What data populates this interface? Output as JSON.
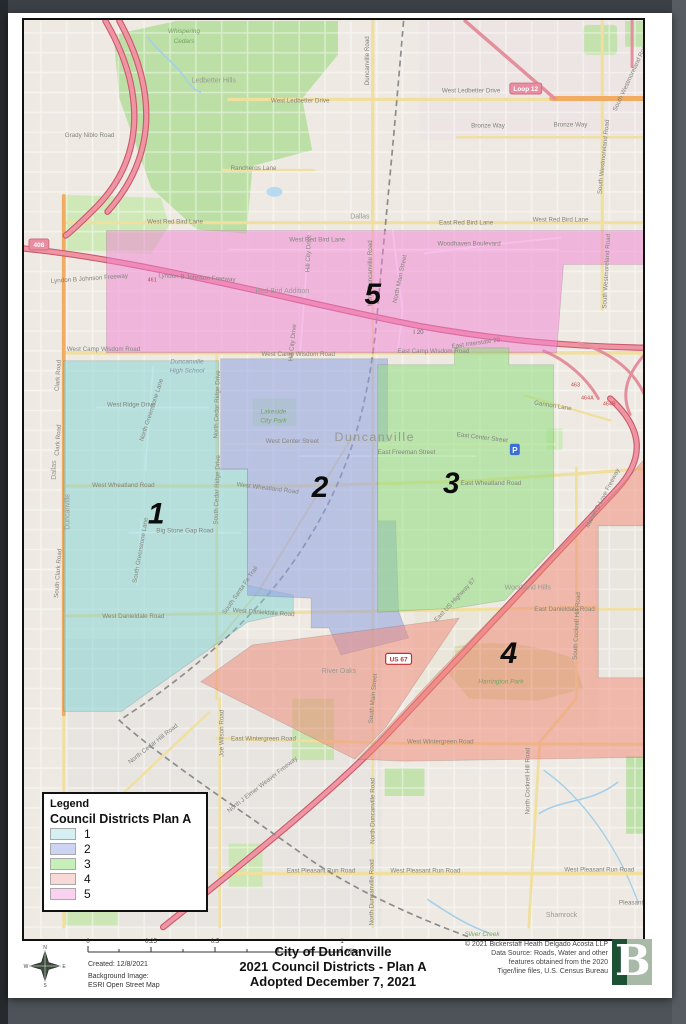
{
  "legend": {
    "title": "Legend",
    "subtitle": "Council Districts Plan A",
    "items": [
      {
        "label": "1",
        "color": "#d4f0f2",
        "dots": "false"
      },
      {
        "label": "2",
        "color": "#cdd3f2",
        "dots": "true"
      },
      {
        "label": "3",
        "color": "#c6efba",
        "dots": "false"
      },
      {
        "label": "4",
        "color": "#f7d9d5",
        "dots": "true"
      },
      {
        "label": "5",
        "color": "#fad2f0",
        "dots": "false"
      }
    ]
  },
  "footer": {
    "title1": "City of Duncanville",
    "title2": "2021 Council Districts - Plan A",
    "title3": "Adopted December 7, 2021",
    "created": "Created: 12/8/2021",
    "bg_label": "Background Image:",
    "bg_value": "ESRI Open Street Map",
    "logo_letter": "B",
    "compass": {
      "n": "N",
      "e": "E",
      "s": "S",
      "w": "W"
    },
    "scale": {
      "unit": "Miles",
      "ticks": [
        {
          "t": "0",
          "x": 80
        },
        {
          "t": "0.25",
          "x": 143
        },
        {
          "t": "0.5",
          "x": 207
        },
        {
          "t": "1",
          "x": 334
        }
      ]
    },
    "copyright": [
      {
        "t": "© 2021 Bickerstaff Heath Delgado Acosta LLP",
        "y": 933
      },
      {
        "t": "Data Source: Roads, Water and other",
        "y": 942
      },
      {
        "t": "features obtained from the 2020",
        "y": 951
      },
      {
        "t": "Tiger/line files, U.S. Census Bureau",
        "y": 960
      }
    ]
  },
  "map": {
    "poi_p": "P",
    "districts": [
      {
        "num": "5",
        "color": "#f07fd4",
        "op": "0.5",
        "d": "M105,229 L650,229 L650,263 L565,263 L558,352 L105,352 Z",
        "tf": "translate(373,303)"
      },
      {
        "num": "1",
        "color": "#7ed2d2",
        "op": "0.5",
        "d": "M62,360 L218,360 L218,469 L247,469 L247,586 L293,596 L293,613 L247,623 L120,713 L62,713 Z",
        "tf": "translate(155,524)"
      },
      {
        "num": "2",
        "color": "#8fa0e2",
        "op": "0.55",
        "d": "M220,358 L388,358 L388,441 L378,441 L378,521 L396,521 L399,612 L409,639 L341,656 L329,629 L311,629 L311,599 L247,596 L247,469 L220,469 Z",
        "tf": "translate(320,497)"
      },
      {
        "num": "3",
        "color": "#8fdc7d",
        "op": "0.55",
        "d": "M378,364 L455,364 L455,347 L510,347 L510,364 L555,364 L555,549 L506,601 L456,609 L378,613 Z",
        "tf": "translate(452,493)"
      },
      {
        "num": "4",
        "color": "#f08573",
        "op": "0.5",
        "d": "M655,449 L655,526 L600,526 L600,679 L655,679 L655,759 L405,763 L358,761 L440,673 L530,581 L621,488 Z M200,683 L355,761 L386,729 L460,619 L252,646 Z",
        "tf": "translate(510,664)"
      }
    ],
    "shields": [
      {
        "t": "Loop 12",
        "tf": "translate(527,86)",
        "cls": "sh-loop",
        "tcls": "sh-txt-loop",
        "w": 32,
        "xo": -16
      },
      {
        "t": "408",
        "tf": "translate(37,243)",
        "cls": "sh-loop",
        "tcls": "sh-txt-loop",
        "w": 20,
        "xo": -10
      },
      {
        "t": "US 67",
        "tf": "translate(399,660)",
        "cls": "sh-us",
        "tcls": "sh-txt-us",
        "w": 26,
        "xo": -13
      }
    ],
    "exits": [
      {
        "t": "461",
        "tf": "translate(151,280)"
      },
      {
        "t": "463",
        "tf": "translate(577,386)"
      },
      {
        "t": "464A",
        "tf": "translate(589,399)"
      },
      {
        "t": "464B",
        "tf": "translate(611,405)"
      },
      {
        "t": "I 20",
        "tf": "translate(419,333)",
        "c": "i20"
      }
    ],
    "labels": [
      {
        "t": "Whispering",
        "tf": "translate(183,30)",
        "c": "place"
      },
      {
        "t": "Cedars",
        "tf": "translate(183,40)",
        "c": "place"
      },
      {
        "t": "Ledbetter Hills",
        "tf": "translate(213,80)",
        "c": "hood"
      },
      {
        "t": "West Ledbetter Drive",
        "tf": "translate(300,100)"
      },
      {
        "t": "West Ledbetter Drive",
        "tf": "translate(472,90)"
      },
      {
        "t": "Bronze Way",
        "tf": "translate(489,125)"
      },
      {
        "t": "Bronze Way",
        "tf": "translate(572,124)"
      },
      {
        "t": "Grady Niblo Road",
        "tf": "translate(88,135)"
      },
      {
        "t": "Rancheros Lane",
        "tf": "translate(253,168)"
      },
      {
        "t": "West Red Bird Lane",
        "tf": "translate(174,222)"
      },
      {
        "t": "East Red Bird Lane",
        "tf": "translate(467,223)"
      },
      {
        "t": "West Red Bird Lane",
        "tf": "translate(562,220)"
      },
      {
        "t": "West Red Bird Lane",
        "tf": "translate(317,240)"
      },
      {
        "t": "Woodhaven Boulevard",
        "tf": "translate(470,244)"
      },
      {
        "t": "Dallas",
        "tf": "translate(360,217)",
        "c": "hood"
      },
      {
        "t": "Lyndon B Johnson Freeway",
        "tf": "translate(88,279) rotate(-4)"
      },
      {
        "t": "Lyndon B Johnson Freeway",
        "tf": "translate(196,278) rotate(3)"
      },
      {
        "t": "Red Bird Addition",
        "tf": "translate(282,292)",
        "c": "hood"
      },
      {
        "t": "North Duncanville Road",
        "tf": "translate(372,272) rotate(-90)"
      },
      {
        "t": "North Main Street",
        "tf": "translate(402,278) rotate(-78)"
      },
      {
        "t": "Hill City Drive",
        "tf": "translate(310,252) rotate(-88)"
      },
      {
        "t": "Hill City Drive",
        "tf": "translate(294,342) rotate(-84)"
      },
      {
        "t": "East Interstate 20",
        "tf": "translate(477,344) rotate(-8)"
      },
      {
        "t": "West Camp Wisdom Road",
        "tf": "translate(102,350)"
      },
      {
        "t": "West Camp Wisdom Road",
        "tf": "translate(298,355)"
      },
      {
        "t": "East Camp Wisdom Road",
        "tf": "translate(434,352)"
      },
      {
        "t": "Gannon Lane",
        "tf": "translate(554,407) rotate(9)"
      },
      {
        "t": "Duncanville",
        "tf": "translate(186,363)",
        "c": "school"
      },
      {
        "t": "High School",
        "tf": "translate(186,372)",
        "c": "school"
      },
      {
        "t": "West Ridge Drive",
        "tf": "translate(130,406)"
      },
      {
        "t": "North Greenstone Lane",
        "tf": "translate(152,410) rotate(-72)"
      },
      {
        "t": "North Cedar Ridge Drive",
        "tf": "translate(218,404) rotate(-88)"
      },
      {
        "t": "South Cedar Ridge Drive",
        "tf": "translate(218,490) rotate(-88)"
      },
      {
        "t": "Lakeside",
        "tf": "translate(273,413)",
        "c": "place"
      },
      {
        "t": "City Park",
        "tf": "translate(273,422)",
        "c": "place"
      },
      {
        "t": "Duncanville",
        "tf": "translate(375,441)",
        "c": "city"
      },
      {
        "t": "West Center Street",
        "tf": "translate(292,443)"
      },
      {
        "t": "East Center Street",
        "tf": "translate(483,439) rotate(7)"
      },
      {
        "t": "East Freeman Street",
        "tf": "translate(407,454)"
      },
      {
        "t": "West Wheatland Road",
        "tf": "translate(122,487)"
      },
      {
        "t": "West Wheatland Road",
        "tf": "translate(267,490) rotate(7)"
      },
      {
        "t": "East Wheatland Road",
        "tf": "translate(492,485)"
      },
      {
        "t": "Marvin D Love Freeway",
        "tf": "translate(606,499) rotate(-62)"
      },
      {
        "t": "Big Stone Gap Road",
        "tf": "translate(184,533)"
      },
      {
        "t": "South Greenstone Lane",
        "tf": "translate(141,551) rotate(-80)"
      },
      {
        "t": "South Santa Fe Trail",
        "tf": "translate(241,592) rotate(-55)"
      },
      {
        "t": "Duncanville",
        "tf": "translate(68,512) rotate(-90)",
        "c": "hood"
      },
      {
        "t": "Dallas",
        "tf": "translate(54,470) rotate(-90)",
        "c": "hood"
      },
      {
        "t": "Clark Road",
        "tf": "translate(58,375) rotate(-86)"
      },
      {
        "t": "Clark Road",
        "tf": "translate(58,440) rotate(-86)"
      },
      {
        "t": "South Clark Road",
        "tf": "translate(58,574) rotate(-86)"
      },
      {
        "t": "West Danieldale Road",
        "tf": "translate(132,619)"
      },
      {
        "t": "West Danieldale Road",
        "tf": "translate(263,615) rotate(4)"
      },
      {
        "t": "East Danieldale Road",
        "tf": "translate(566,612)"
      },
      {
        "t": "Woodland Hills",
        "tf": "translate(529,590)",
        "c": "hood"
      },
      {
        "t": "East US Highway 67",
        "tf": "translate(457,602) rotate(-47)"
      },
      {
        "t": "South Cockrell Hill Road",
        "tf": "translate(580,627) rotate(-87)"
      },
      {
        "t": "South Main Street",
        "tf": "translate(375,700) rotate(-85)"
      },
      {
        "t": "Harrington Park",
        "tf": "translate(502,685)",
        "c": "place"
      },
      {
        "t": "River Oaks",
        "tf": "translate(339,674)",
        "c": "hood"
      },
      {
        "t": "North Cedar Hill Road",
        "tf": "translate(153,747) rotate(-38)"
      },
      {
        "t": "Joe Wilson Road",
        "tf": "translate(223,735) rotate(-90)"
      },
      {
        "t": "East Wintergreen Road",
        "tf": "translate(263,742)"
      },
      {
        "t": "West Wintergreen Road",
        "tf": "translate(441,745)"
      },
      {
        "t": "North J Elmer Weaver Freeway",
        "tf": "translate(263,788) rotate(-38)"
      },
      {
        "t": "North Duncanville Road",
        "tf": "translate(375,813) rotate(-90)"
      },
      {
        "t": "North Cockrell Hill Road",
        "tf": "translate(531,783) rotate(-90)"
      },
      {
        "t": "East Pleasant Run Road",
        "tf": "translate(321,875)"
      },
      {
        "t": "West Pleasant Run Road",
        "tf": "translate(426,875)"
      },
      {
        "t": "West Pleasant Run Road",
        "tf": "translate(601,874)"
      },
      {
        "t": "Shamrock",
        "tf": "translate(563,920)",
        "c": "hood"
      },
      {
        "t": "Pleasant",
        "tf": "translate(633,907)"
      },
      {
        "t": "Silver Creek",
        "tf": "translate(483,939)",
        "c": "place"
      },
      {
        "t": "South Westmoreland Road",
        "tf": "translate(607,155) rotate(-84)"
      },
      {
        "t": "South Westmoreland Road",
        "tf": "translate(610,270) rotate(-87)"
      },
      {
        "t": "South Westmoreland Road",
        "tf": "translate(634,75) rotate(-65)"
      },
      {
        "t": "Duncanville Road",
        "tf": "translate(369,58) rotate(-90)"
      },
      {
        "t": "North Duncanville Road",
        "tf": "translate(374,895) rotate(-90)"
      }
    ]
  }
}
